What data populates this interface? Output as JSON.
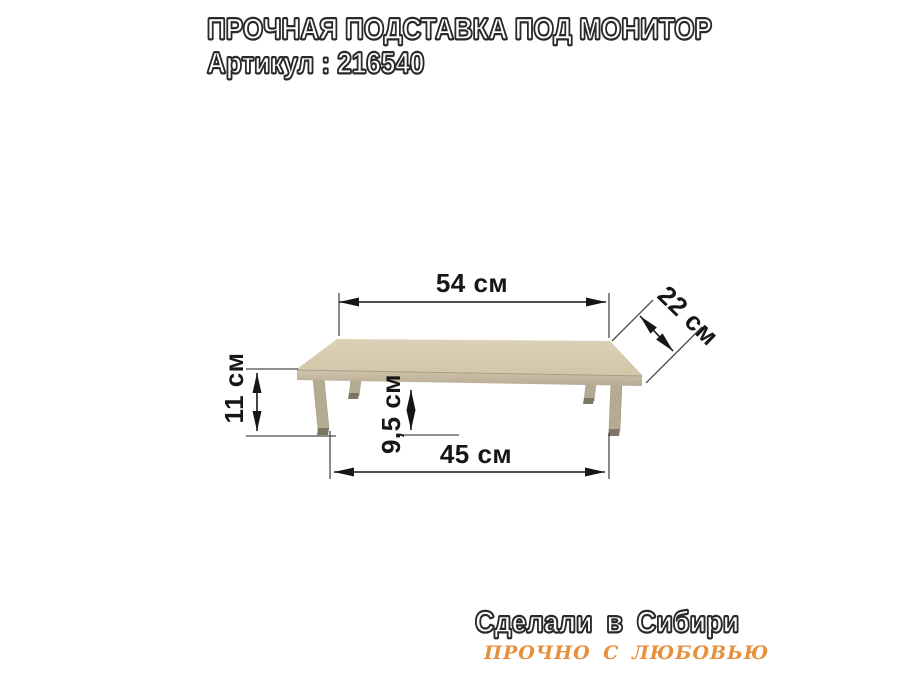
{
  "header": {
    "title": "ПРОЧНАЯ ПОДСТАВКА ПОД МОНИТОР",
    "article": "Артикул : 216540"
  },
  "diagram": {
    "product": "monitor-stand",
    "dimensions": {
      "top_width": "54 см",
      "depth": "22 см",
      "height": "11 см",
      "clearance": "9,5 см",
      "leg_span": "45 см"
    },
    "colors": {
      "top_surface": "#d6c9ad",
      "edge_band": "#c6baa2",
      "leg": "#b5aa92",
      "leg_cap": "#7d7565",
      "dimension_lines": "#161616"
    }
  },
  "footer": {
    "made_in": "Сделали в Сибири",
    "slogan": "ПРОЧНО С ЛЮБОВЬЮ",
    "slogan_color": "#e78f3b"
  }
}
